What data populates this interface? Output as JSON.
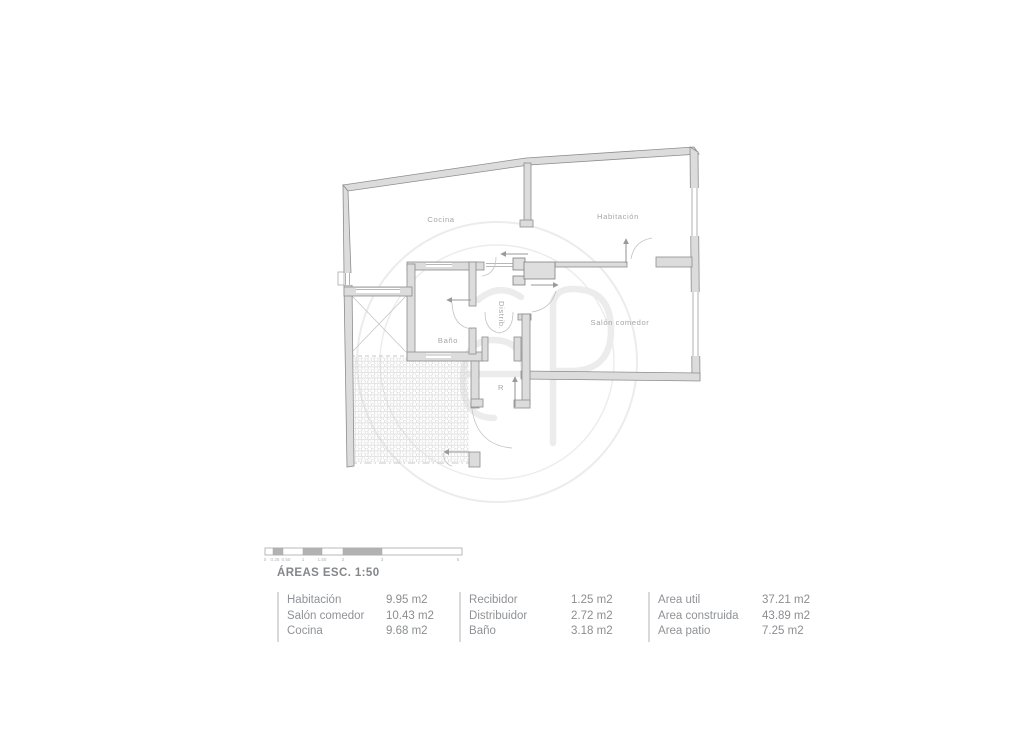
{
  "plan": {
    "rooms": {
      "cocina": "Cocina",
      "habitacion": "Habitación",
      "salon": "Salón comedor",
      "bano": "Baño",
      "distrib": "Distrib.",
      "recibidor_abbr": "R"
    }
  },
  "scale_bar": {
    "labels": [
      "0",
      "0.25",
      "0.50",
      "1",
      "1.50",
      "2",
      "3",
      "5"
    ]
  },
  "areas": {
    "title": "ÁREAS ESC. 1:50",
    "columns": [
      {
        "rows": [
          {
            "label": "Habitación",
            "value": "9.95 m2"
          },
          {
            "label": "Salón comedor",
            "value": "10.43 m2"
          },
          {
            "label": "Cocina",
            "value": "9.68 m2"
          }
        ]
      },
      {
        "rows": [
          {
            "label": "Recibidor",
            "value": "1.25 m2"
          },
          {
            "label": "Distribuidor",
            "value": "2.72 m2"
          },
          {
            "label": "Baño",
            "value": "3.18 m2"
          }
        ]
      },
      {
        "rows": [
          {
            "label": "Area util",
            "value": "37.21 m2"
          },
          {
            "label": "Area construida",
            "value": "43.89 m2"
          },
          {
            "label": "Area patio",
            "value": "7.25 m2"
          }
        ]
      }
    ]
  },
  "colors": {
    "wall_fill": "#dcdcdc",
    "wall_stroke": "#8d8d8d",
    "label_gray": "#a4a6a8",
    "watermark": "#ececec",
    "text_gray": "#8f9296"
  }
}
